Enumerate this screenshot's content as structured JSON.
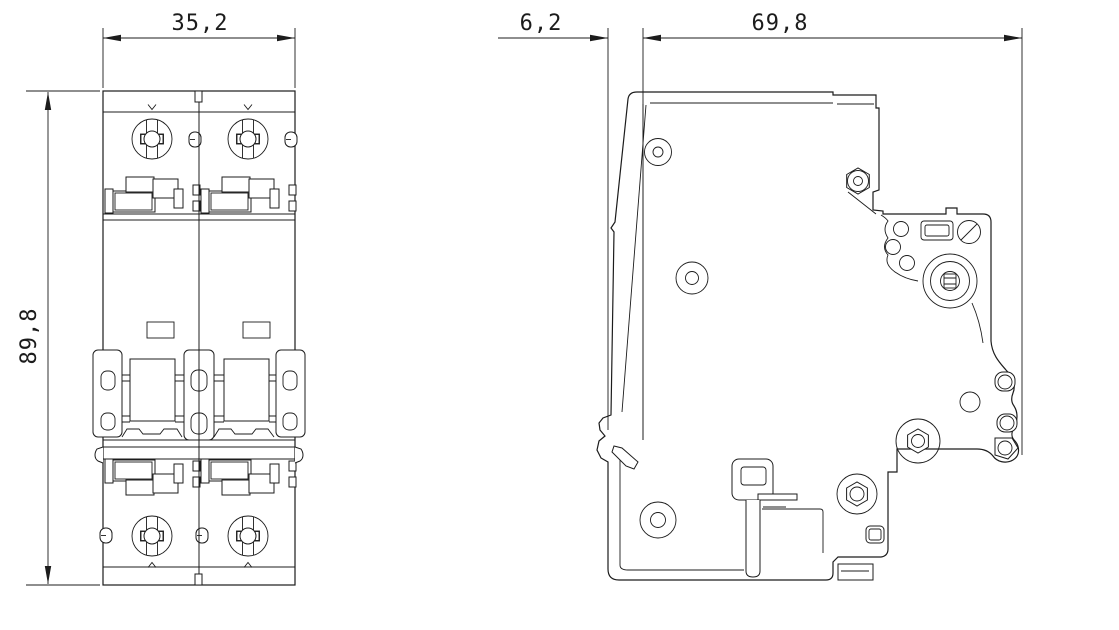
{
  "dimensions": {
    "front_width": "35,2",
    "front_height": "89,8",
    "side_rail_offset": "6,2",
    "side_depth": "69,8"
  },
  "colors": {
    "background": "#ffffff",
    "line": "#1c1c1c"
  }
}
